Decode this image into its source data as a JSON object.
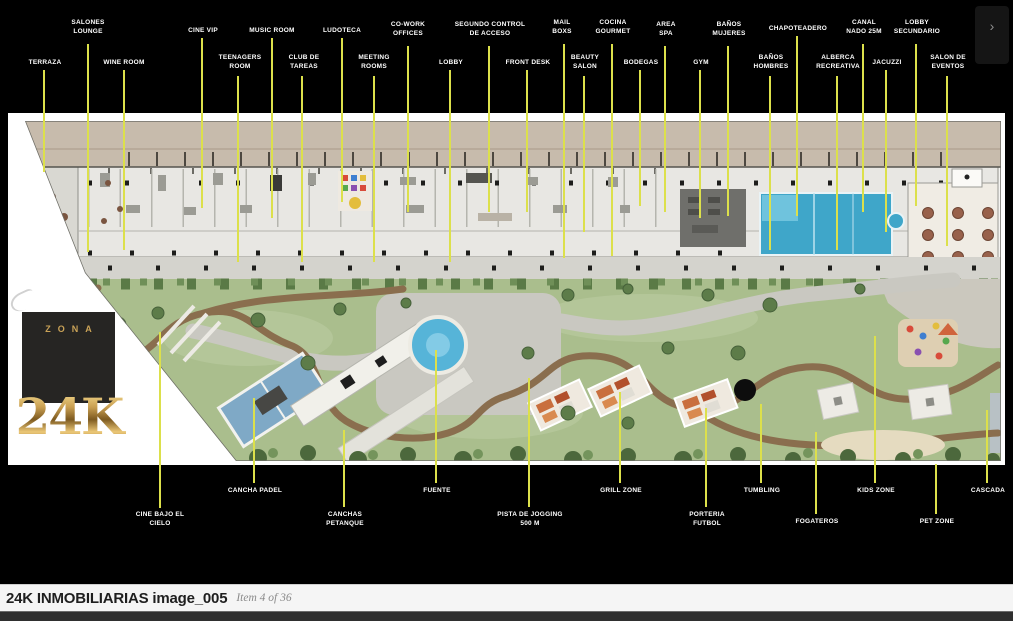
{
  "colors": {
    "leader": "#dce04b",
    "gold": "#c9a257",
    "footer_text": "#1f1f1f",
    "footer_muted": "#8a8a8a",
    "pool_blue": "#3fa6c9",
    "lawn_green": "#aabe8d"
  },
  "viewer": {
    "next_button": "›"
  },
  "logo": {
    "top": "ZONA",
    "big": "24K"
  },
  "footer": {
    "title": "24K INMOBILIARIAS image_005",
    "item": "Item 4 of 36"
  },
  "labels": {
    "top": [
      {
        "text": "TERRAZA"
      },
      {
        "text": "SALONES LOUNGE"
      },
      {
        "text": "WINE ROOM"
      },
      {
        "text": "CINE VIP"
      },
      {
        "text": "TEENAGERS ROOM"
      },
      {
        "text": "MUSIC ROOM"
      },
      {
        "text": "CLUB DE TAREAS"
      },
      {
        "text": "LUDOTECA"
      },
      {
        "text": "MEETING ROOMS"
      },
      {
        "text": "CO-WORK OFFICES"
      },
      {
        "text": "LOBBY"
      },
      {
        "text": "SEGUNDO CONTROL DE ACCESO"
      },
      {
        "text": "FRONT DESK"
      },
      {
        "text": "MAIL BOXS"
      },
      {
        "text": "BEAUTY SALON"
      },
      {
        "text": "COCINA GOURMET"
      },
      {
        "text": "BODEGAS"
      },
      {
        "text": "AREA SPA"
      },
      {
        "text": "GYM"
      },
      {
        "text": "BAÑOS MUJERES"
      },
      {
        "text": "BAÑOS HOMBRES"
      },
      {
        "text": "CHAPOTEADERO"
      },
      {
        "text": "ALBERCA RECREATIVA"
      },
      {
        "text": "CANAL NADO 25M"
      },
      {
        "text": "JACUZZI"
      },
      {
        "text": "LOBBY SECUNDARIO"
      },
      {
        "text": "SALON DE EVENTOS"
      }
    ],
    "bottom": [
      {
        "text": "CINE BAJO EL CIELO"
      },
      {
        "text": "CANCHA PADEL"
      },
      {
        "text": "CANCHAS PETANQUE"
      },
      {
        "text": "FUENTE"
      },
      {
        "text": "PISTA DE JOGGING 500 M"
      },
      {
        "text": "GRILL ZONE"
      },
      {
        "text": "PORTERIA FUTBOL"
      },
      {
        "text": "TUMBLING"
      },
      {
        "text": "FOGATEROS"
      },
      {
        "text": "KIDS ZONE"
      },
      {
        "text": "PET ZONE"
      },
      {
        "text": "CASCADA"
      }
    ]
  }
}
